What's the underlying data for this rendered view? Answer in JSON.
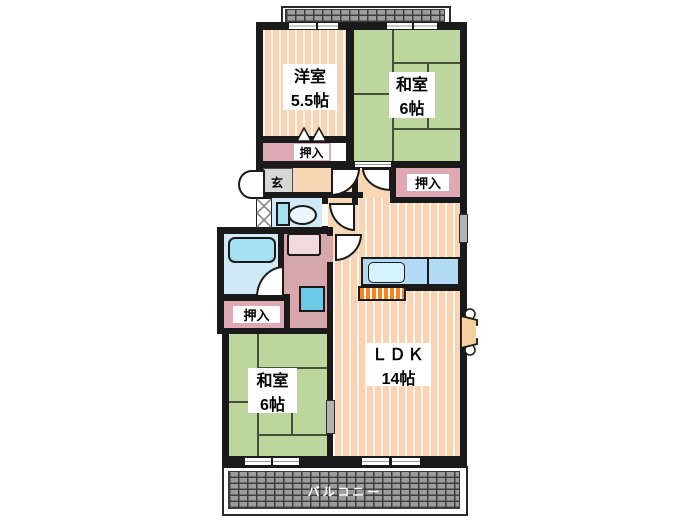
{
  "plan": {
    "rooms": [
      {
        "id": "yoshitsu",
        "name": "洋室",
        "size": "5.5帖"
      },
      {
        "id": "washitsu-top",
        "name": "和室",
        "size": "6帖"
      },
      {
        "id": "washitsu-bottom",
        "name": "和室",
        "size": "6帖"
      },
      {
        "id": "ldk",
        "name": "ＬＤＫ",
        "size": "14帖"
      }
    ],
    "labels": {
      "closet": "押入",
      "entrance": "玄",
      "balcony": "バルコニー"
    },
    "colors": {
      "wall": "#1a1a1a",
      "flooring": "#f8d4b2",
      "tatami": "#bcd69d",
      "closet_pink": "#dfa9b3",
      "water_blue": "#cfe9f7",
      "kitchen_counter": "#b3daf4",
      "stove_orange": "#f5831e",
      "entrance_gray": "#d7d7d7",
      "balcony_tile": "#9d9d9d"
    }
  }
}
